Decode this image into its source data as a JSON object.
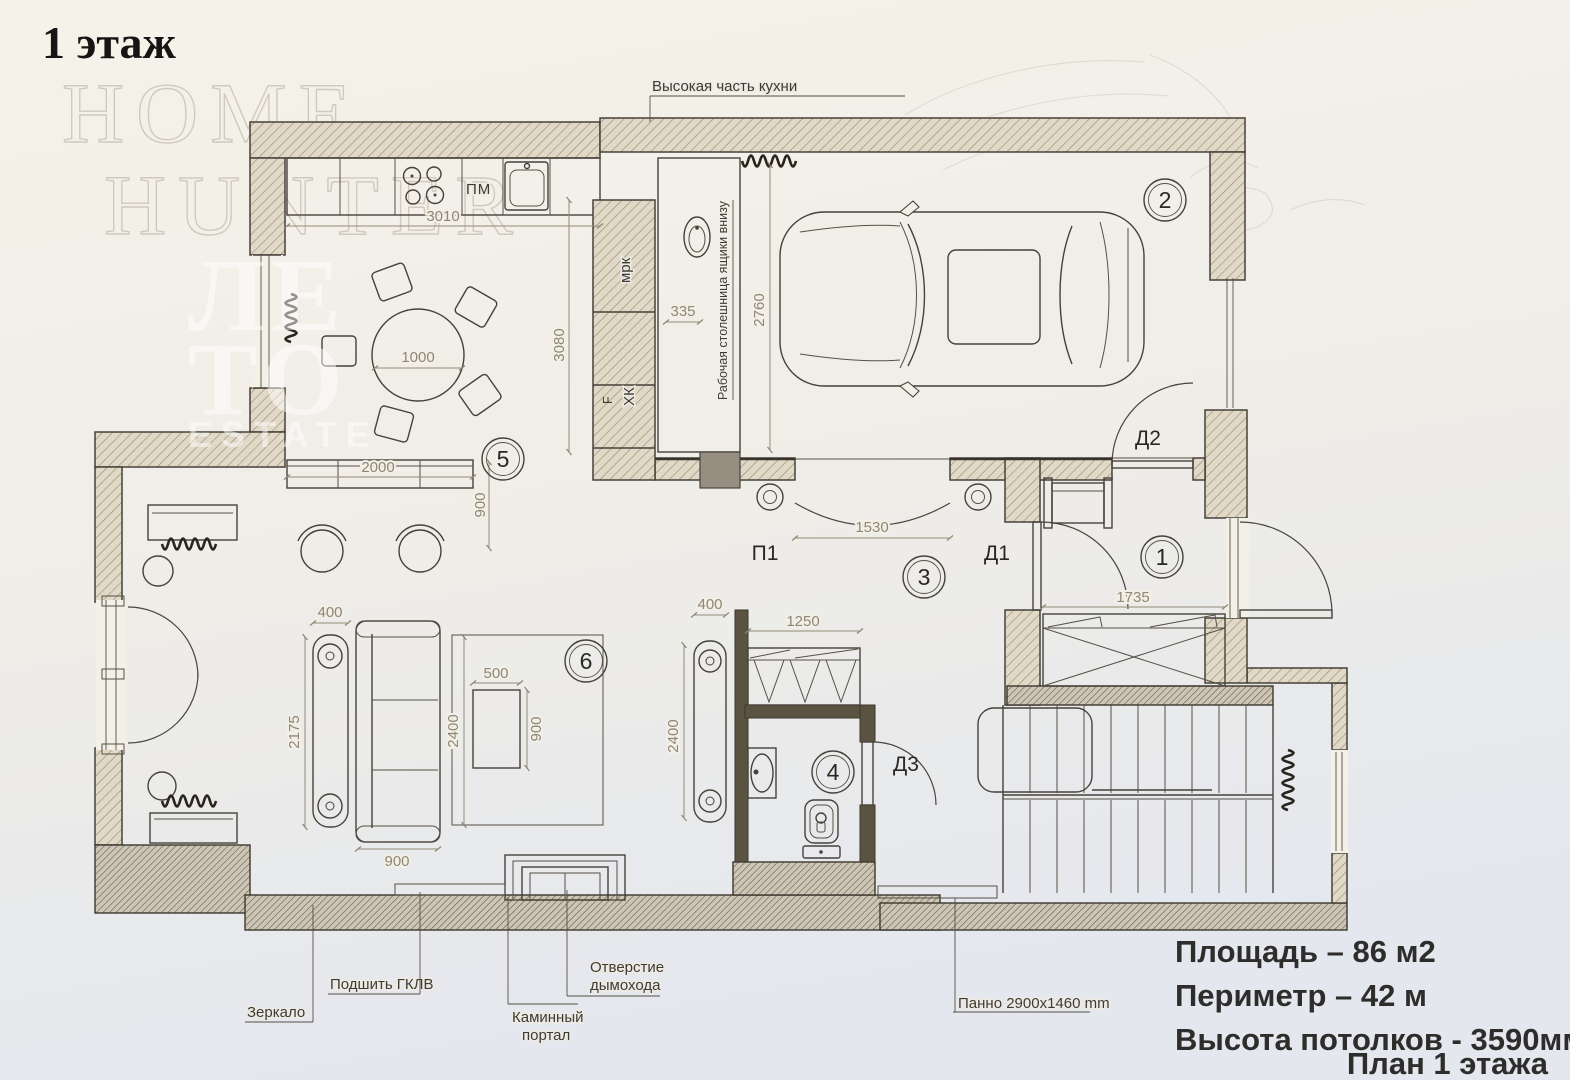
{
  "title": "1 этаж",
  "watermark": {
    "home": "HOME",
    "hunter": "HUNTER",
    "leto_top": "ЛЕ",
    "leto_bottom": "ТО",
    "estate": "ESTATE"
  },
  "info": {
    "area": "Площадь – 86 м2",
    "perimeter": "Периметр – 42 м",
    "ceiling": "Высота потолков - 3590мм",
    "plan": "План 1 этажа"
  },
  "rooms": {
    "r1": "1",
    "r2": "2",
    "r3": "3",
    "r4": "4",
    "r5": "5",
    "r6": "6"
  },
  "doors": {
    "d1": "Д1",
    "d2": "Д2",
    "d3": "Д3",
    "p1": "П1"
  },
  "labels": {
    "high_kitchen": "Высокая часть кухни",
    "worktop": "Рабочая столешница  ящики внизу",
    "mrk": "мрк",
    "f": "F",
    "hk": "ХК",
    "pm": "ПМ",
    "mirror": "Зеркало",
    "gklv": "Подшить ГКЛВ",
    "fireplace_1": "Каминный",
    "fireplace_2": "портал",
    "chimney_1": "Отверстие",
    "chimney_2": "дымохода",
    "panel": "Панно 2900х1460 mm"
  },
  "dimensions": {
    "kitchen_run": "3010",
    "dining_table": "1000",
    "bar_counter": "2000",
    "bar_depth": "900",
    "kitchen_depth": "3080",
    "worktop_width": "335",
    "garage_width": "2760",
    "p1_opening": "1530",
    "entry_wardrobe": "1735",
    "bath_wardrobe": "1250",
    "console_left_width": "400",
    "console_left_length": "2175",
    "console_right_width": "400",
    "console_right_length": "2400",
    "rug_length": "2400",
    "coffee_table_width": "500",
    "coffee_table_length": "900",
    "sofa_width": "900"
  }
}
